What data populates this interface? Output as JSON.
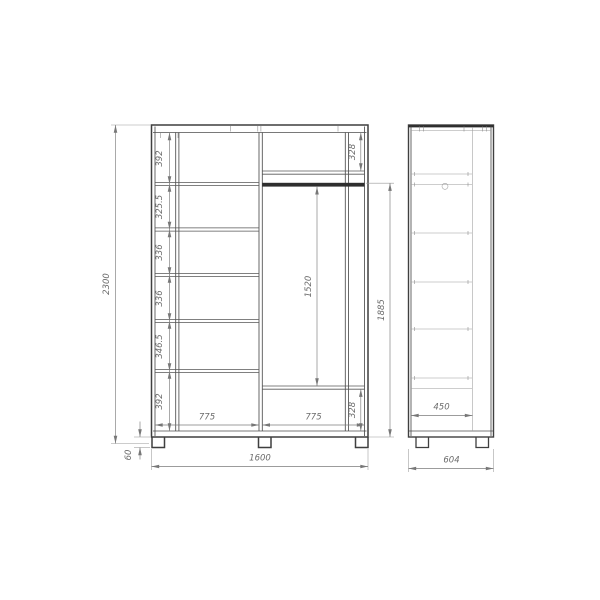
{
  "front": {
    "total_height": "2300",
    "shelf_chain": [
      "392",
      "325.5",
      "336",
      "336",
      "346.5",
      "392"
    ],
    "top_right": "328",
    "bottom_right": "328",
    "rod_clearance": "1520",
    "rod_height": "1885",
    "section_left": "775",
    "section_right": "775",
    "total_width": "1600",
    "leg_height": "60"
  },
  "side": {
    "shelf_depth": "450",
    "total_depth": "604"
  },
  "colors": {
    "main_line": "#3f3f3f",
    "dim_text": "#6b6b6b",
    "rod_fill": "#2e2e2e"
  }
}
